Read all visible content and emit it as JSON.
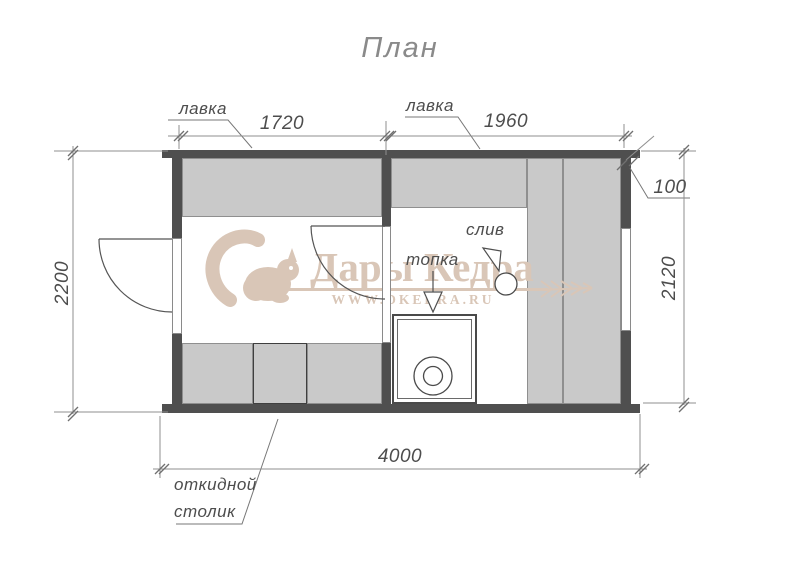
{
  "title": "План",
  "watermark": {
    "brand": "Дары Кедра",
    "site": "WWW.DKEDRA.RU"
  },
  "labels": {
    "bench_left": "лавка",
    "bench_right": "лавка",
    "stove": "топка",
    "drain": "слив",
    "folding_table_line1": "откидной",
    "folding_table_line2": "столик"
  },
  "dimensions": {
    "room_left_width": "1720",
    "room_right_width": "1960",
    "wall_offset": "100",
    "height_left": "2200",
    "height_right": "2120",
    "total_width": "4000"
  },
  "colors": {
    "wall": "#4f4f4f",
    "bench": "#c9c9c9",
    "watermark": "#d9c6b7",
    "line": "#8f8f8f",
    "text": "#4d4d4d"
  }
}
